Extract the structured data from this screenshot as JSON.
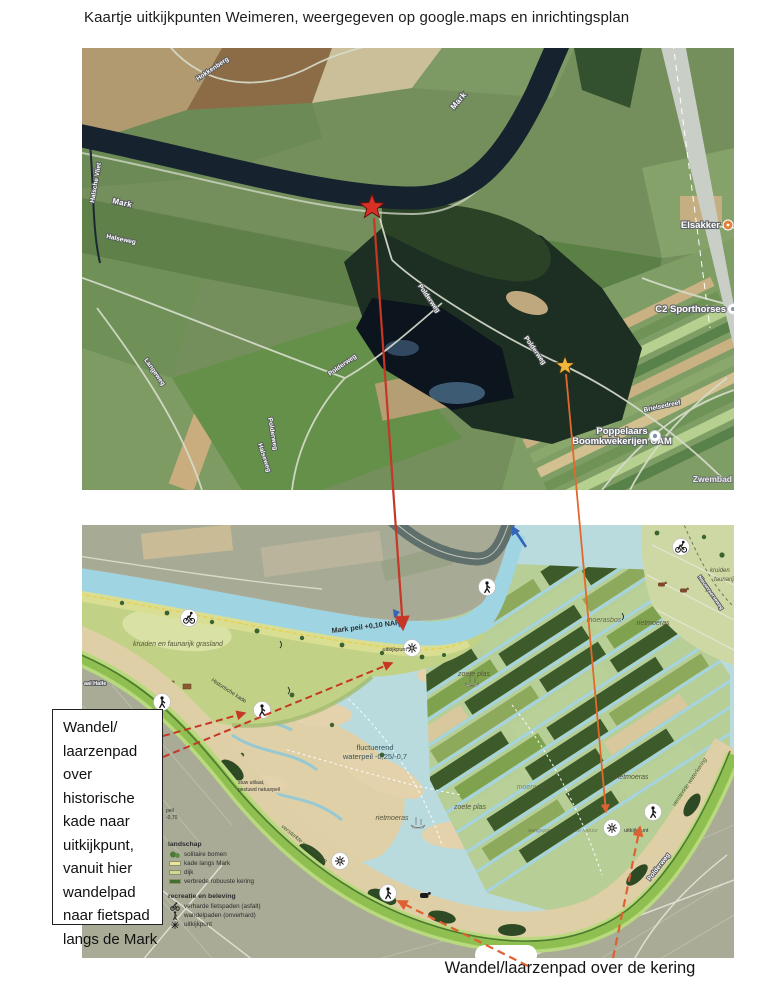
{
  "title": "Kaartje uitkijkpunten Weimeren, weergegeven op google.maps en inrichtingsplan",
  "colors": {
    "red_marker": "#d93025",
    "yellow_marker": "#f2b63a",
    "arrow_red": "#c63726",
    "arrow_orange": "#df6030",
    "plan_water": "#aed6dd",
    "plan_kering_green": "#8fbf51"
  },
  "sat": {
    "roads": [
      "Mark",
      "Mark",
      "Halsche Vliet",
      "Halseweg",
      "Langeweg",
      "Halseweg",
      "Polderweg",
      "Polderweg",
      "Polderweg",
      "Polderweg",
      "Hokkenberg",
      "Brielsedreef"
    ],
    "places": {
      "elsakker": "Elsakker",
      "c2": "C2 Sporthorses",
      "pop1": "Poppelaars",
      "pop2": "Boomkwekerijen CAM",
      "zwembad": "Zwembad"
    }
  },
  "plan": {
    "labels": {
      "mark_peil": "Mark peil +0,10 NAP",
      "grasland": "kruiden en faunarijk grasland",
      "hist_kade": "Historische kade",
      "halle": "aal Halle",
      "stuw1": "stuw uitlaat,",
      "stuw2": "gestuwd natuurpeil",
      "fluct1": "fluctuerend",
      "fluct2": "waterpeil -0,25/-0,7",
      "zoete1": "zoete plas",
      "zoete2": "zoete plas",
      "riet1": "rietmoeras",
      "riet2": "rietmoeras",
      "riet3": "rietmoeras",
      "moeras1": "moerasbos",
      "moeras2": "moerasbos",
      "natuur": "aangepast bestaande natuur",
      "uitkijk1": "uitkijkpunt",
      "uitkijk2": "uitkijkpunt",
      "kering1": "versterkte waterkering",
      "kering2": "versterkte waterkering",
      "kruiden_edge1": "kruiden",
      "kruiden_edge2": "faunarijk",
      "weg_edge": "Nieuwveerseweg",
      "polderweg_sat": "Polderweg",
      "peil_part1": "peil",
      "peil_part2": "-0,70"
    },
    "legend": {
      "h1": "landschap",
      "items1": [
        "solitaire bomen",
        "kade langs Mark",
        "dijk",
        "verbrede robuuste kering"
      ],
      "h2": "recreatie en beleving",
      "items2": [
        "verharde fietspaden (asfalt)",
        "wandelpaden (onverhard)",
        "uitkijkpunt"
      ]
    }
  },
  "annotations": {
    "note_lines": [
      "Wandel/",
      "laarzenpad",
      "over",
      "historische",
      "kade naar",
      "uitkijkpunt,",
      "vanuit hier",
      "wandelpad",
      "naar fietspad",
      "langs de Mark"
    ],
    "caption": "Wandel/laarzenpad over de kering"
  }
}
